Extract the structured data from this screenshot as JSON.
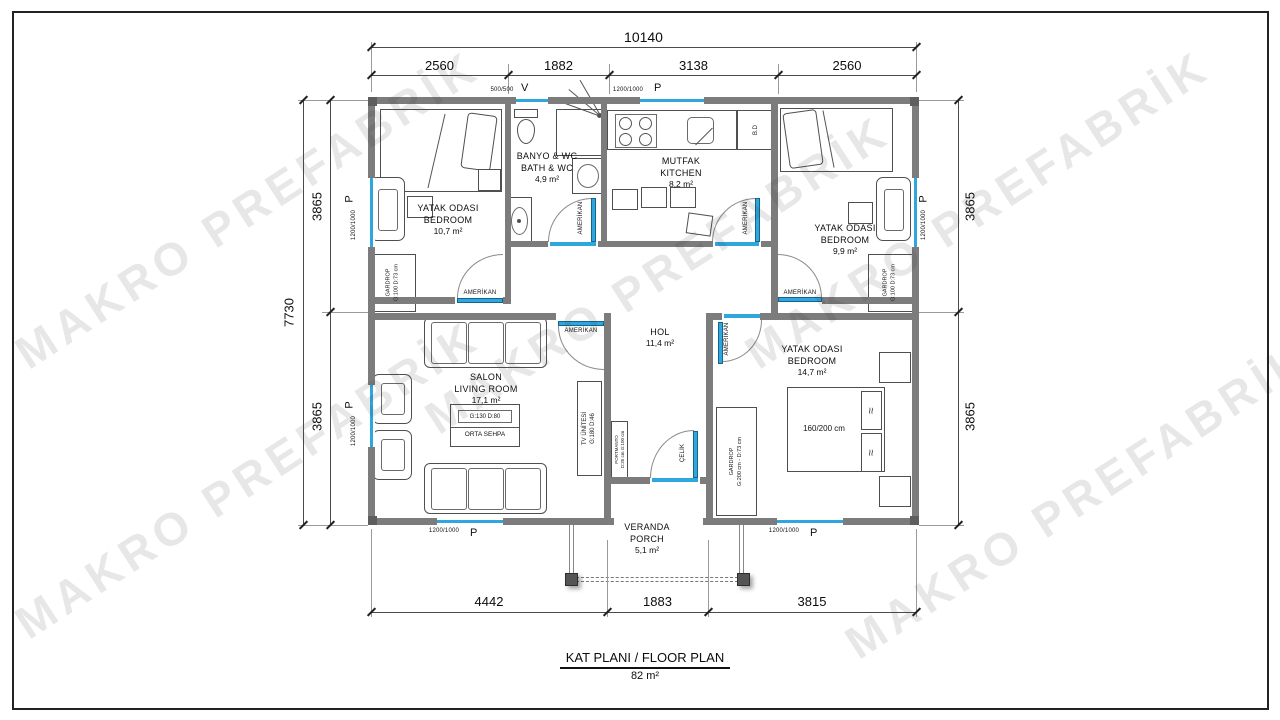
{
  "title": {
    "main": "KAT PLANI / FLOOR PLAN",
    "area": "82 m²"
  },
  "watermark": {
    "text": "MAKRO PREFABRİK"
  },
  "dimensions": {
    "top_total": "10140",
    "top_segments": [
      "2560",
      "1882",
      "3138",
      "2560"
    ],
    "left_total": "7730",
    "left_segments": [
      "3865",
      "3865"
    ],
    "right_segments": [
      "3865",
      "3865"
    ],
    "bottom_segments": [
      "4442",
      "1883",
      "3815"
    ]
  },
  "rooms": {
    "bedroom1": {
      "title": "YATAK ODASI",
      "subtitle": "BEDROOM",
      "area": "10,7 m²"
    },
    "bathroom": {
      "title": "BANYO & WC",
      "subtitle": "BATH & WC",
      "area": "4,9 m²"
    },
    "kitchen": {
      "title": "MUTFAK",
      "subtitle": "KITCHEN",
      "area": "8,2 m²"
    },
    "bedroom2": {
      "title": "YATAK ODASI",
      "subtitle": "BEDROOM",
      "area": "9,9 m²"
    },
    "living": {
      "title": "SALON",
      "subtitle": "LIVING ROOM",
      "area": "17,1 m²"
    },
    "hall": {
      "title": "HOL",
      "area": "11,4 m²"
    },
    "bedroom3": {
      "title": "YATAK ODASI",
      "subtitle": "BEDROOM",
      "area": "14,7 m²"
    },
    "veranda": {
      "title": "VERANDA",
      "subtitle": "PORCH",
      "area": "5,1 m²"
    }
  },
  "furniture": {
    "gardrop_name": "GARDROP",
    "gardrop_small_size": "G:100 D:73 cm",
    "gardrop_large_size": "G:200 cm - D:73 cm",
    "tv_name": "TV ÜNİTESİ",
    "tv_size": "G:180 D:46",
    "coffee_size": "G:130 D:80",
    "coffee_name": "ORTA SEHPA",
    "portmanto_name": "PORTMANTO",
    "portmanto_size": "D:35 cm G:100 cm",
    "bed_double_size": "160/200 cm",
    "fridge": "B.D",
    "pillow_glyph": "≈"
  },
  "openings": {
    "amerikan": "AMERİKAN",
    "celik": "ÇELİK",
    "w500": "500/500",
    "w1200": "1200/1000",
    "v": "V",
    "p": "P"
  },
  "colors": {
    "window_blue": "#2da7dd",
    "wall_gray": "#7c7c7c"
  }
}
